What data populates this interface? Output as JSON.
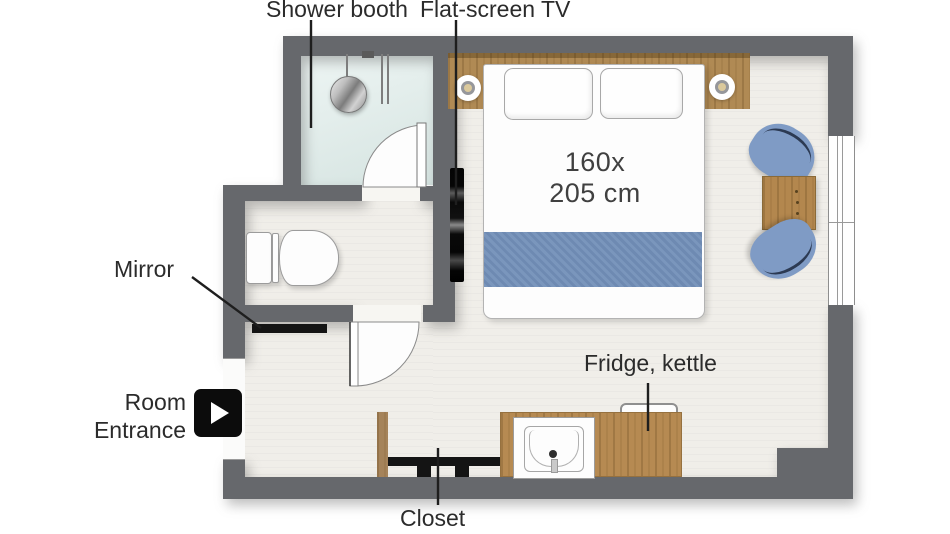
{
  "title": "Hotel room floor plan",
  "labels": {
    "shower": "Shower booth",
    "tv": "Flat-screen TV",
    "mirror": "Mirror",
    "entrance_line1": "Room",
    "entrance_line2": "Entrance",
    "fridge": "Fridge, kettle",
    "closet": "Closet"
  },
  "bed": {
    "size_line1": "160x",
    "size_line2": "205 cm"
  },
  "icons": {
    "entrance": "play-right-icon",
    "shower_head": "shower-head-icon",
    "ceiling_lights": "wall-sconce-icon"
  },
  "colors": {
    "wall": "#66686c",
    "floor": "#f0eee9",
    "bathroom_floor": "#dcebe8",
    "wood_headboard": "#b08a54",
    "wood_counter": "#b68a52",
    "wood_closet": "#a5835a",
    "table_wood": "#b3874e",
    "blanket_blue": "#7390b9",
    "chair_blue": "#7f9bc5",
    "tv_black": "#0c0c0c",
    "mirror_black": "#121212",
    "label_text": "#2b2b2b"
  }
}
